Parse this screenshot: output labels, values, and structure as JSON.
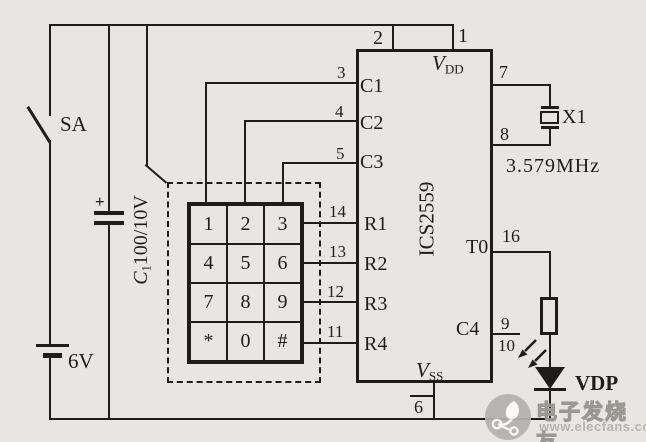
{
  "switch": {
    "label": "SA"
  },
  "battery": {
    "label": "6V"
  },
  "capacitor": {
    "plus": "+",
    "prefix": "C",
    "sub": "1",
    "value": "100/10V"
  },
  "ic": {
    "name": "ICS2559",
    "vdd": {
      "main": "V",
      "sub": "DD"
    },
    "vss": {
      "main": "V",
      "sub": "SS"
    },
    "top_pins": [
      {
        "num": "2"
      },
      {
        "num": "1"
      }
    ],
    "left_pins": [
      {
        "num": "3",
        "label": "C1"
      },
      {
        "num": "4",
        "label": "C2"
      },
      {
        "num": "5",
        "label": "C3"
      },
      {
        "num": "14",
        "label": "R1"
      },
      {
        "num": "13",
        "label": "R2"
      },
      {
        "num": "12",
        "label": "R3"
      },
      {
        "num": "11",
        "label": "R4"
      }
    ],
    "right_pins": {
      "p7": "7",
      "p8": "8",
      "p16": "16",
      "p9": "9",
      "p10": "10"
    },
    "right_labels": {
      "t0": "T0",
      "c4": "C4"
    },
    "bottom_pin": "6"
  },
  "crystal": {
    "ref": "X1",
    "freq": "3.579MHz"
  },
  "led": {
    "ref": "VDP"
  },
  "keypad": {
    "keys": [
      "1",
      "2",
      "3",
      "4",
      "5",
      "6",
      "7",
      "8",
      "9",
      "*",
      "0",
      "#"
    ]
  },
  "watermark": {
    "name": "电子发烧友",
    "url": "www.elecfans.com"
  },
  "colors": {
    "ink": "#1f1d1b",
    "paper": "#e7e6e3",
    "watermark": "#b3b1ad"
  }
}
